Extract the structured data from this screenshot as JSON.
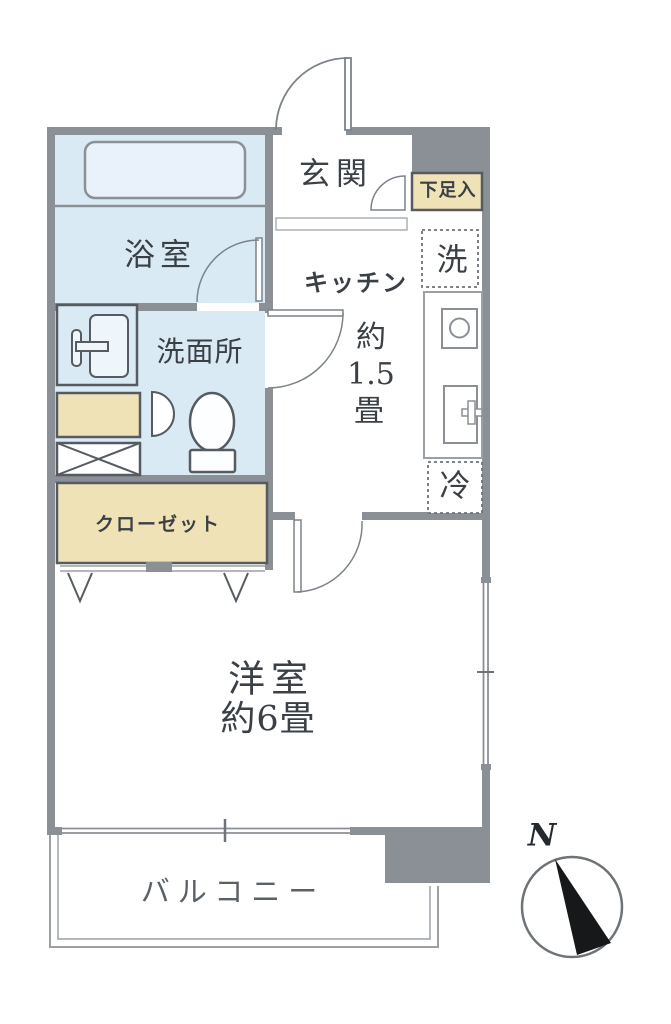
{
  "floorplan": {
    "rooms": {
      "genkan": {
        "label": "玄関"
      },
      "shoe_cabinet": {
        "label": "下足入"
      },
      "bathroom": {
        "label": "浴室"
      },
      "washroom": {
        "label": "洗面所"
      },
      "kitchen": {
        "label": "キッチン",
        "size_prefix": "約",
        "size_value": "1.5",
        "size_unit": "畳"
      },
      "closet": {
        "label": "クローゼット"
      },
      "western_room": {
        "label": "洋室",
        "size": "約6畳"
      },
      "balcony": {
        "label": "バルコニー"
      }
    },
    "appliances": {
      "washer": {
        "label": "洗"
      },
      "fridge": {
        "label": "冷"
      }
    },
    "compass": {
      "north_label": "N"
    },
    "colors": {
      "wall": "#8b9096",
      "water_rooms": "#daeaf5",
      "storage": "#efe2b6",
      "text": "#3b4046",
      "balcony_text": "#5a6067",
      "compass_needle": "#16181a"
    }
  }
}
